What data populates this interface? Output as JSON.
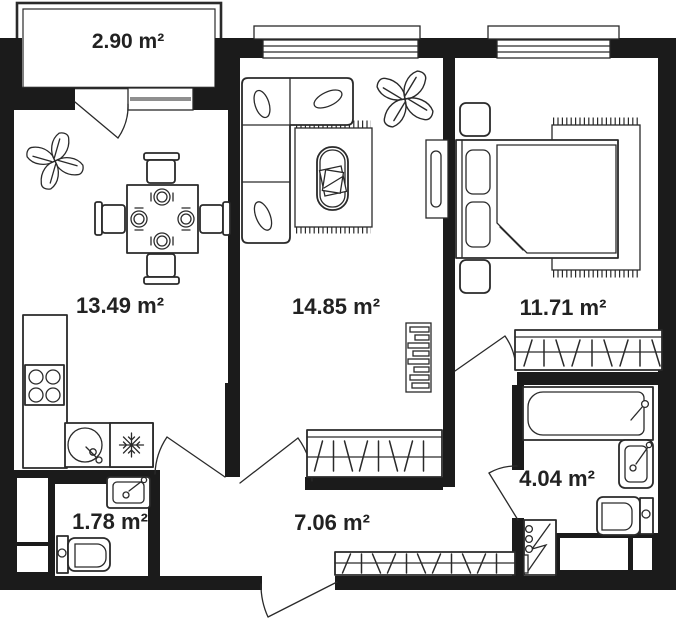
{
  "type": "apartment-floor-plan",
  "rooms": {
    "balcony": {
      "area": "2.90 m²"
    },
    "kitchen_dining": {
      "area": "13.49 m²"
    },
    "living_room": {
      "area": "14.85 m²"
    },
    "bedroom": {
      "area": "11.71 m²"
    },
    "hallway": {
      "area": "7.06 m²"
    },
    "toilet": {
      "area": "1.78 m²"
    },
    "bathroom": {
      "area": "4.04 m²"
    }
  },
  "colors": {
    "walls": "#1b1b1b",
    "lines": "#2a2a2a",
    "background": "#ffffff",
    "label_text": "#222222",
    "window_glass_line": "#8f8f8f"
  },
  "furniture_icons": [
    "plant-icon",
    "dining-table-icon",
    "chair-icon",
    "plate-icon",
    "kitchen-counter-icon",
    "stove-icon",
    "round-sink-icon",
    "fridge-snowflake-icon",
    "sofa-icon",
    "pillow-icon",
    "rug-icon",
    "coffee-table-icon",
    "radiator-icon",
    "shelf-icon",
    "bed-icon",
    "nightstand-icon",
    "wardrobe-hatch-icon",
    "bathtub-icon",
    "washbasin-icon",
    "toilet-icon",
    "electric-panel-icon",
    "door-swing-icon",
    "window-icon",
    "window-sill-icon"
  ]
}
